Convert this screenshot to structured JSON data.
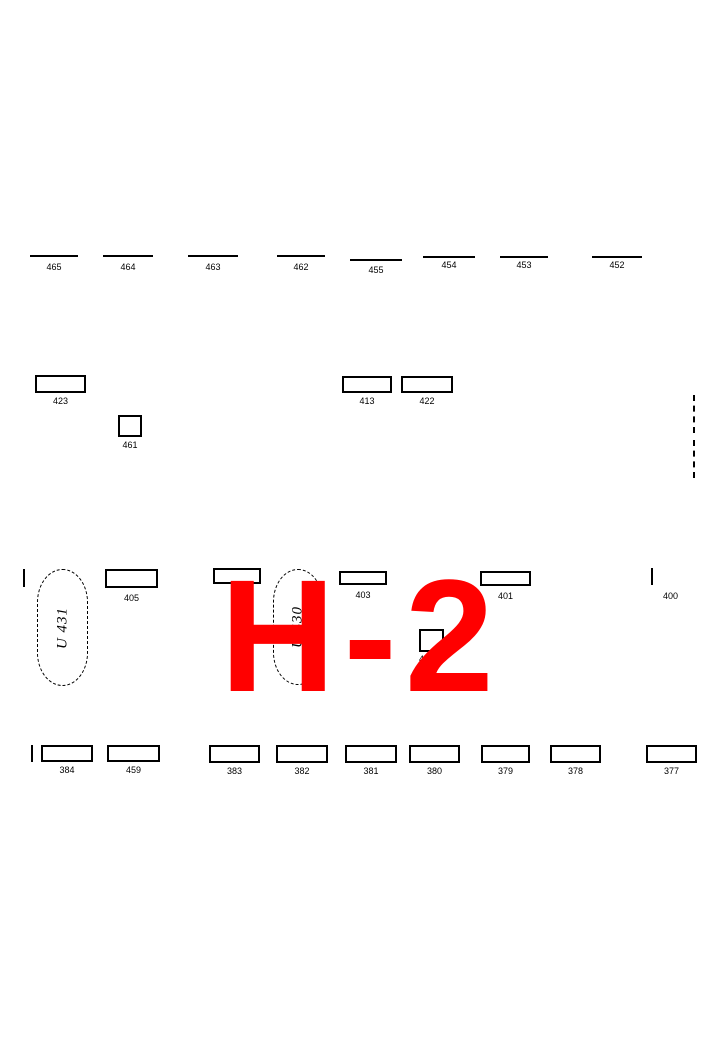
{
  "section_overlay": {
    "text": "H-2",
    "color": "#ff0000"
  },
  "colors": {
    "ink": "#000000",
    "background": "#ffffff",
    "accent": "#ff0000"
  },
  "top_row": [
    {
      "label": "465",
      "x": 30,
      "w": 48,
      "y": 255,
      "ly": 263
    },
    {
      "label": "464",
      "x": 103,
      "w": 50,
      "y": 255,
      "ly": 263
    },
    {
      "label": "463",
      "x": 188,
      "w": 50,
      "y": 255,
      "ly": 263
    },
    {
      "label": "462",
      "x": 277,
      "w": 48,
      "y": 255,
      "ly": 263
    },
    {
      "label": "455",
      "x": 350,
      "w": 52,
      "y": 259,
      "ly": 266
    },
    {
      "label": "454",
      "x": 423,
      "w": 52,
      "y": 256,
      "ly": 261
    },
    {
      "label": "453",
      "x": 500,
      "w": 48,
      "y": 256,
      "ly": 261
    },
    {
      "label": "452",
      "x": 592,
      "w": 50,
      "y": 256,
      "ly": 261
    }
  ],
  "mid_plots": [
    {
      "label": "423",
      "x": 35,
      "y": 375,
      "w": 51,
      "h": 18
    },
    {
      "label": "413",
      "x": 342,
      "y": 376,
      "w": 50,
      "h": 17
    },
    {
      "label": "422",
      "x": 401,
      "y": 376,
      "w": 52,
      "h": 17
    },
    {
      "label": "461",
      "x": 118,
      "y": 415,
      "w": 24,
      "h": 22
    }
  ],
  "right_boundary": {
    "x": 693,
    "segments": [
      [
        395,
        433
      ],
      [
        440,
        478
      ]
    ]
  },
  "center_row": {
    "left_tick": {
      "x": 23,
      "y": 569,
      "h": 18
    },
    "urn_plots": [
      {
        "label": "U 431",
        "x": 37,
        "y": 569,
        "w": 51,
        "h": 117
      },
      {
        "label": "U 430",
        "x": 273,
        "y": 569,
        "w": 50,
        "h": 116
      }
    ],
    "plots": [
      {
        "label": "405",
        "x": 105,
        "y": 569,
        "w": 53,
        "h": 19
      },
      {
        "label": "",
        "x": 213,
        "y": 568,
        "w": 48,
        "h": 16
      },
      {
        "label": "403",
        "x": 339,
        "y": 571,
        "w": 48,
        "h": 14
      },
      {
        "label": "402",
        "x": 419,
        "y": 629,
        "w": 25,
        "h": 23,
        "label_align": "left"
      },
      {
        "label": "401",
        "x": 480,
        "y": 571,
        "w": 51,
        "h": 15
      }
    ],
    "right_tick": {
      "label": "400",
      "x": 651,
      "y": 568,
      "h": 17,
      "lx": 663,
      "ly": 592
    }
  },
  "bottom_row": {
    "left_tick": {
      "x": 31,
      "y": 745,
      "h": 17
    },
    "plots": [
      {
        "label": "384",
        "x": 41,
        "y": 745,
        "w": 52,
        "h": 17
      },
      {
        "label": "459",
        "x": 107,
        "y": 745,
        "w": 53,
        "h": 17
      },
      {
        "label": "383",
        "x": 209,
        "y": 745,
        "w": 51,
        "h": 18
      },
      {
        "label": "382",
        "x": 276,
        "y": 745,
        "w": 52,
        "h": 18
      },
      {
        "label": "381",
        "x": 345,
        "y": 745,
        "w": 52,
        "h": 18
      },
      {
        "label": "380",
        "x": 409,
        "y": 745,
        "w": 51,
        "h": 18
      },
      {
        "label": "379",
        "x": 481,
        "y": 745,
        "w": 49,
        "h": 18
      },
      {
        "label": "378",
        "x": 550,
        "y": 745,
        "w": 51,
        "h": 18
      },
      {
        "label": "377",
        "x": 646,
        "y": 745,
        "w": 51,
        "h": 18
      }
    ]
  }
}
